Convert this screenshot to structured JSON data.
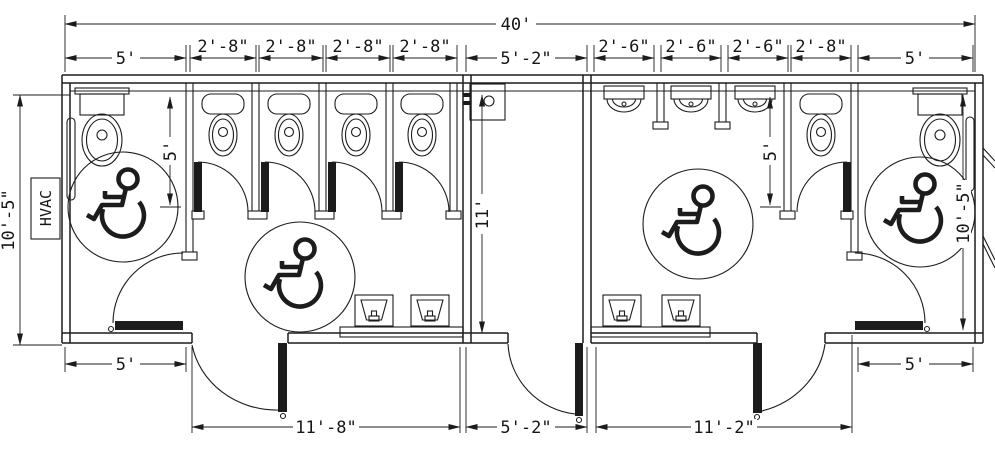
{
  "colors": {
    "line": "#1c1c1c",
    "background": "#ffffff"
  },
  "labels": {
    "hvac": "HVAC"
  },
  "dims": {
    "overall_width": "40'",
    "womens_acc_stall_width": "5'",
    "womens_stall_width": "2'-8\"",
    "corridor_width": "5'-2\"",
    "urinal_stall_width": "2'-6\"",
    "mens_stall_width": "2'-8\"",
    "mens_acc_stall_width": "5'",
    "left_room_depth": "10'-5\"",
    "womens_stall_depth": "5'",
    "corridor_depth": "11'",
    "mens_stall_depth": "5'",
    "right_room_depth": "10'-5\"",
    "womens_acc_stall_width_bottom": "5'",
    "womens_entry_width": "11'-8\"",
    "corridor_width_bottom": "5'-2\"",
    "mens_entry_width": "11'-2\"",
    "mens_acc_stall_width_bottom": "5'"
  }
}
